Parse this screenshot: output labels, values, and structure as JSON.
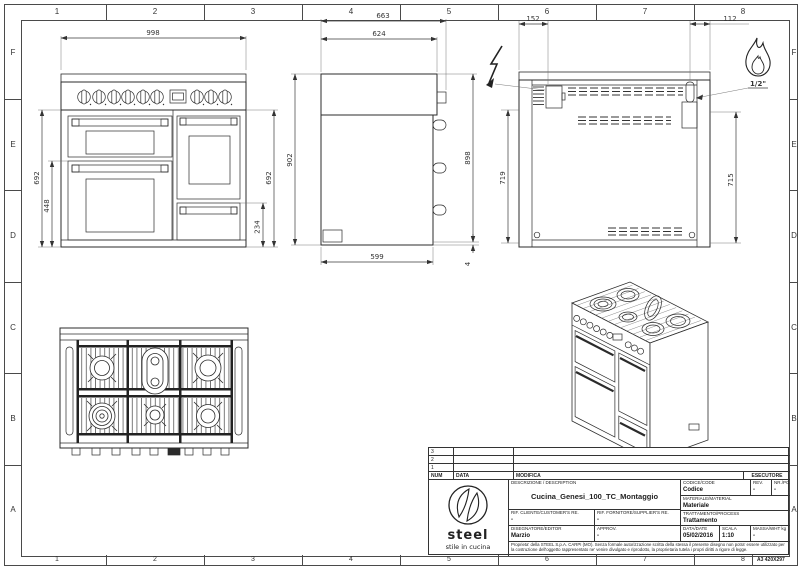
{
  "sheet": {
    "columns": [
      "1",
      "2",
      "3",
      "4",
      "5",
      "6",
      "7",
      "8"
    ],
    "rows": [
      "F",
      "E",
      "D",
      "C",
      "B",
      "A"
    ],
    "format_label": "A3 420X297"
  },
  "views": {
    "front": {
      "dims": {
        "width": "998",
        "left_height": "692",
        "door_height": "448",
        "right_height": "692",
        "drawer_height": "234"
      }
    },
    "side": {
      "dims": {
        "overall_depth": "663",
        "top_depth": "624",
        "left_height": "902",
        "right_height": "898",
        "base_depth": "599",
        "base_gap": "4"
      }
    },
    "rear": {
      "dims": {
        "electric_offset": "152",
        "gas_offset": "112",
        "left_height": "719",
        "right_height": "715"
      },
      "gas_connection_label": "1/2\"",
      "icons": {
        "electric": "lightning-bolt",
        "gas": "flame"
      }
    }
  },
  "title_block": {
    "revision_table": {
      "rows": [
        "3",
        "2",
        "1"
      ],
      "num_header": "NUM",
      "date_header": "DATA",
      "modification_header": "MODIFICA",
      "executor_header": "ESECUTORE"
    },
    "logo": {
      "brand": "steel",
      "tagline": "stile in cucina"
    },
    "description_label": "DESCRIZIONE / DESCRIPTION",
    "description": "Cucina_Genesi_100_TC_Montaggio",
    "code_label": "CODICE/CODE",
    "code": "Codice",
    "rev_label": "REV.",
    "rev": "-",
    "nr_label": "NR./PC.",
    "nr": "-",
    "material_label": "MATERIALE/MATERIAL",
    "material": "Materiale",
    "customer_ref_label": "RIF. CLIENTE/CUSTOMER'S RE.",
    "customer_ref": "-",
    "supplier_ref_label": "RIF. FORNITORE/SUPPLIER'S RE.",
    "supplier_ref": "-",
    "process_label": "TRATTAMENTO/PROCESS",
    "process": "Trattamento",
    "editor_label": "DISEGNATORE/EDITOR",
    "editor": "Marzio",
    "approval_label": "APPROV.",
    "approval": "-",
    "date_label": "DATA/DATE",
    "date": "05/02/2016",
    "scale_label": "SCALA",
    "scale": "1:10",
    "mass_label": "MASSA/WHT kg",
    "mass": "-",
    "disclaimer": "Proprieta' della STEEL S.p.A. CARPI (MO). Senza formale autorizzazione scritta della stessa il presente disegno non potra' essere utilizzato per la costruzione dell'oggetto rappresentato ne' venire divulgato e riprodotto, la proprietaria tutela i propri diritti a rigore di legge."
  }
}
